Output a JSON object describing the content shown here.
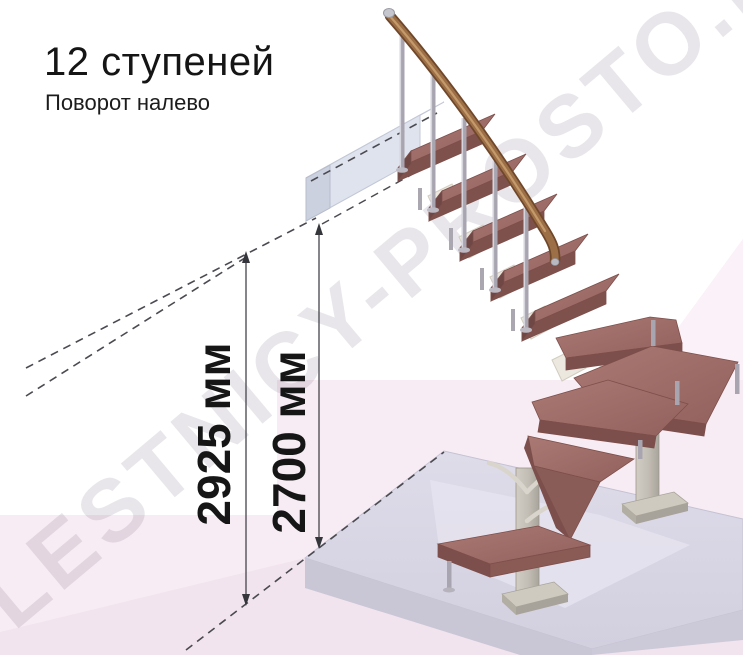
{
  "header": {
    "title": "12 ступеней",
    "subtitle": "Поворот налево"
  },
  "watermark": "LESTNICY-PROSTO.RU",
  "dimensions": [
    {
      "id": "overall-height",
      "label": "2925 мм"
    },
    {
      "id": "floor-to-landing-height",
      "label": "2700 мм"
    }
  ],
  "figure": {
    "type": "3d-staircase-render",
    "steps_count": 12,
    "turn_direction": "налево",
    "palette": {
      "tread_top": "#a1706b",
      "tread_edge": "#7c4f4c",
      "handrail": "#9c6f47",
      "metal_baluster": "#a8a5b0",
      "support_column": "#c6c1b8",
      "landing_beam": "#e6eaf3",
      "floor_slab": "#d9d7e5",
      "wall_pink": "#f8ecf4",
      "floor_pink": "#f2e4ee",
      "dimension_line": "#45454c",
      "text": "#161616"
    }
  }
}
